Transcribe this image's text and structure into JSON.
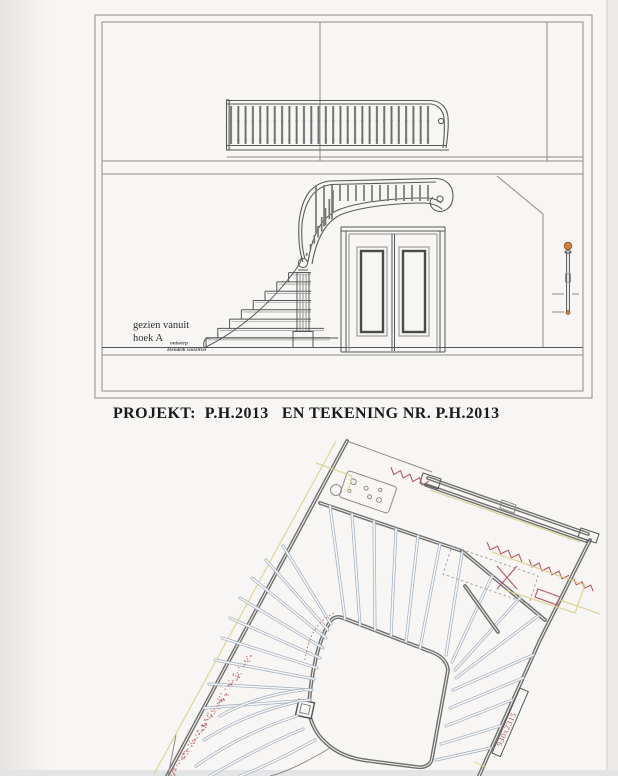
{
  "page": {
    "paper_color": "#f7f6f4",
    "type": "scanned architectural drawing"
  },
  "title_block": {
    "text": "PROJEKT:  P.H.2013   EN TEKENING NR. P.H.2013"
  },
  "elevation": {
    "caption_line1": "gezien vanuit",
    "caption_line2": "hoek A",
    "credit_line1": "ontwerp",
    "credit_line2": "Hendrik vanDriel",
    "upper_balusters": 28,
    "landing_balusters": 15,
    "wreath_balusters": 9,
    "steps": 8,
    "knob_color": "#d2823c"
  },
  "plan": {
    "dimension_label": "930x2315",
    "tread_color": "#9fadbf",
    "wall_color": "#6e6e6c",
    "red_color": "#b55a62",
    "yellow_color": "#d8d084",
    "stipple_dots": 140
  }
}
